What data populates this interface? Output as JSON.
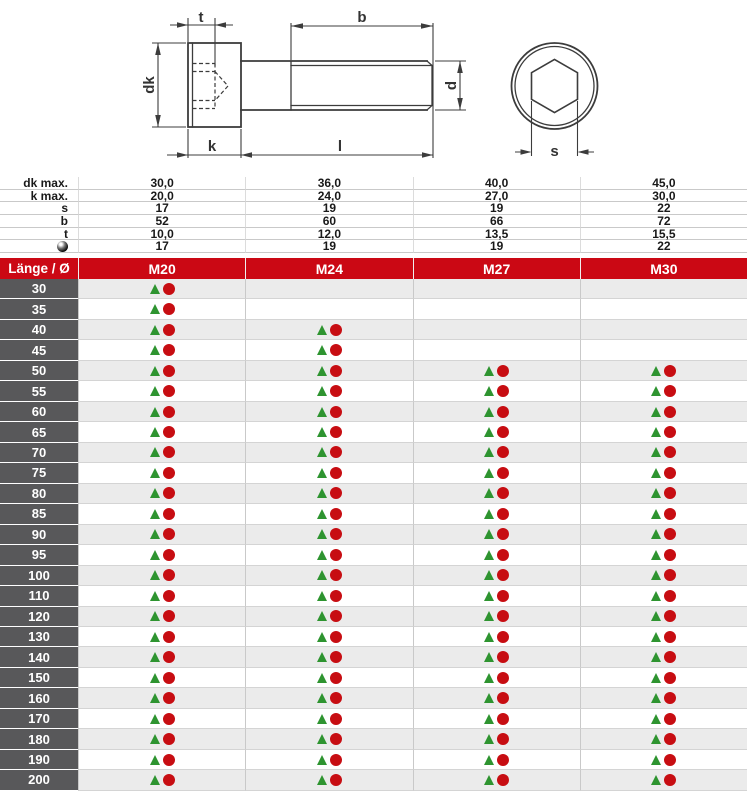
{
  "drawing": {
    "dim_labels": {
      "socket_depth": "t",
      "thread_length": "b",
      "head_diameter": "dk",
      "head_height": "k",
      "shank_length": "l",
      "thread_diameter": "d",
      "socket_width": "s"
    }
  },
  "spec_table": {
    "rows": [
      {
        "key": "dk-max",
        "label": "dk max.",
        "values": [
          "30,0",
          "36,0",
          "40,0",
          "45,0"
        ]
      },
      {
        "key": "k-max",
        "label": "k max.",
        "values": [
          "20,0",
          "24,0",
          "27,0",
          "30,0"
        ]
      },
      {
        "key": "s",
        "label": "s",
        "values": [
          "17",
          "19",
          "19",
          "22"
        ]
      },
      {
        "key": "b",
        "label": "b",
        "values": [
          "52",
          "60",
          "66",
          "72"
        ]
      },
      {
        "key": "t",
        "label": "t",
        "values": [
          "10,0",
          "12,0",
          "13,5",
          "15,5"
        ]
      },
      {
        "key": "key-size",
        "label": "",
        "icon": "ball-icon",
        "values": [
          "17",
          "19",
          "19",
          "22"
        ]
      }
    ]
  },
  "main_table": {
    "length_header": "Länge / Ø",
    "columns": [
      "M20",
      "M24",
      "M27",
      "M30"
    ],
    "rows": [
      {
        "length": "30",
        "available": [
          true,
          false,
          false,
          false
        ]
      },
      {
        "length": "35",
        "available": [
          true,
          false,
          false,
          false
        ]
      },
      {
        "length": "40",
        "available": [
          true,
          true,
          false,
          false
        ]
      },
      {
        "length": "45",
        "available": [
          true,
          true,
          false,
          false
        ]
      },
      {
        "length": "50",
        "available": [
          true,
          true,
          true,
          true
        ]
      },
      {
        "length": "55",
        "available": [
          true,
          true,
          true,
          true
        ]
      },
      {
        "length": "60",
        "available": [
          true,
          true,
          true,
          true
        ]
      },
      {
        "length": "65",
        "available": [
          true,
          true,
          true,
          true
        ]
      },
      {
        "length": "70",
        "available": [
          true,
          true,
          true,
          true
        ]
      },
      {
        "length": "75",
        "available": [
          true,
          true,
          true,
          true
        ]
      },
      {
        "length": "80",
        "available": [
          true,
          true,
          true,
          true
        ]
      },
      {
        "length": "85",
        "available": [
          true,
          true,
          true,
          true
        ]
      },
      {
        "length": "90",
        "available": [
          true,
          true,
          true,
          true
        ]
      },
      {
        "length": "95",
        "available": [
          true,
          true,
          true,
          true
        ]
      },
      {
        "length": "100",
        "available": [
          true,
          true,
          true,
          true
        ]
      },
      {
        "length": "110",
        "available": [
          true,
          true,
          true,
          true
        ]
      },
      {
        "length": "120",
        "available": [
          true,
          true,
          true,
          true
        ]
      },
      {
        "length": "130",
        "available": [
          true,
          true,
          true,
          true
        ]
      },
      {
        "length": "140",
        "available": [
          true,
          true,
          true,
          true
        ]
      },
      {
        "length": "150",
        "available": [
          true,
          true,
          true,
          true
        ]
      },
      {
        "length": "160",
        "available": [
          true,
          true,
          true,
          true
        ]
      },
      {
        "length": "170",
        "available": [
          true,
          true,
          true,
          true
        ]
      },
      {
        "length": "180",
        "available": [
          true,
          true,
          true,
          true
        ]
      },
      {
        "length": "190",
        "available": [
          true,
          true,
          true,
          true
        ]
      },
      {
        "length": "200",
        "available": [
          true,
          true,
          true,
          true
        ]
      }
    ]
  },
  "colors": {
    "header_red": "#cb0814",
    "marker_green": "#2e9430",
    "marker_red": "#c70d12",
    "row_dark_gray": "#58585a",
    "stripe_gray": "#ebebeb"
  }
}
